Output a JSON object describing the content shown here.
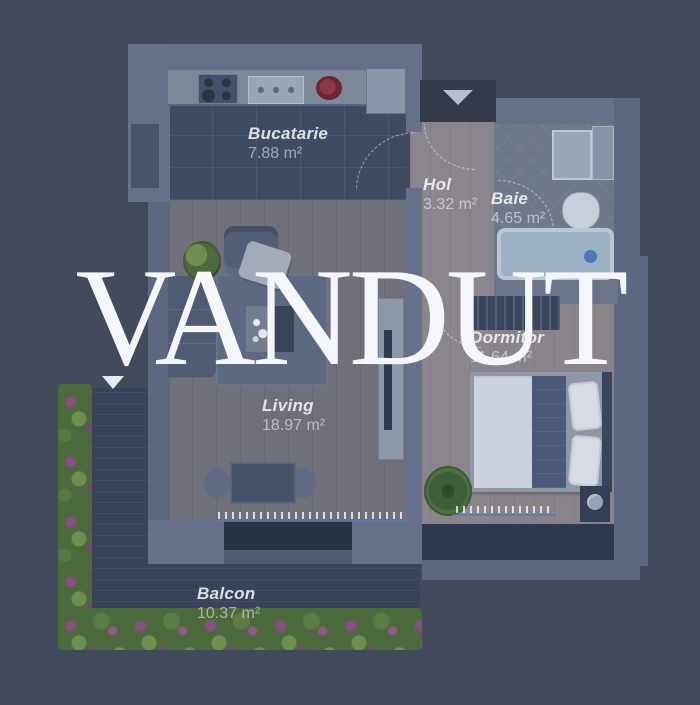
{
  "watermark": {
    "text": "VANDUT",
    "color": "#f4f6f9"
  },
  "page": {
    "background_color": "#424a5c"
  },
  "floorplan": {
    "type": "apartment-floor-plan",
    "rooms": [
      {
        "id": "bucatarie",
        "name": "Bucatarie",
        "area": "7.88 m²"
      },
      {
        "id": "hol",
        "name": "Hol",
        "area": "3.32 m²"
      },
      {
        "id": "baie",
        "name": "Baie",
        "area": "4.65 m²"
      },
      {
        "id": "dormitor",
        "name": "Dormitor",
        "area": "11.64 m²"
      },
      {
        "id": "living",
        "name": "Living",
        "area": "18.97 m²"
      },
      {
        "id": "balcon",
        "name": "Balcon",
        "area": "10.37 m²"
      }
    ],
    "icons": {
      "entrance_arrow": "triangle-down",
      "balcony_marker": "triangle-down"
    },
    "colors": {
      "wall": "#67718a",
      "wood_floor": "#8b868d",
      "living_floor": "#70707b",
      "kitchen_floor": "#3f4b63",
      "bathroom_floor": "#6f7889",
      "balcony_floor": "#38435a",
      "hedge_green": "#4d6a3e",
      "flower_purple": "#8a4f82",
      "bathtub_blue": "#9db1c5",
      "label_text": "#ffffff"
    }
  }
}
